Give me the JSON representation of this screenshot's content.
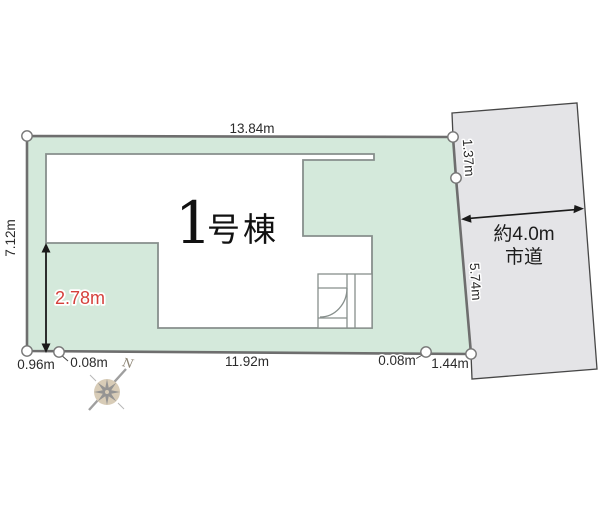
{
  "title": {
    "number": "1",
    "suffix": "号棟"
  },
  "road": {
    "line1": "約4.0m",
    "line2": "市道"
  },
  "dims": {
    "top": "13.84m",
    "left": "7.12m",
    "right_upper": "1.37m",
    "right_lower": "5.74m",
    "setback": "2.78m",
    "bottom_seg1": "0.96m",
    "bottom_seg2": "0.08m",
    "bottom_seg3": "11.92m",
    "bottom_seg4": "0.08m",
    "bottom_seg5": "1.44m"
  },
  "compass": {
    "north": "N"
  },
  "colors": {
    "plot_fill": "#d4e9db",
    "plot_border": "#6e6e6e",
    "road_fill": "#e4e4e7",
    "road_border": "#474747",
    "building_border": "#878f8c",
    "accent_red": "#d5403c",
    "compass_rose": "#d8ccb7",
    "compass_star": "#8f8f8f"
  }
}
